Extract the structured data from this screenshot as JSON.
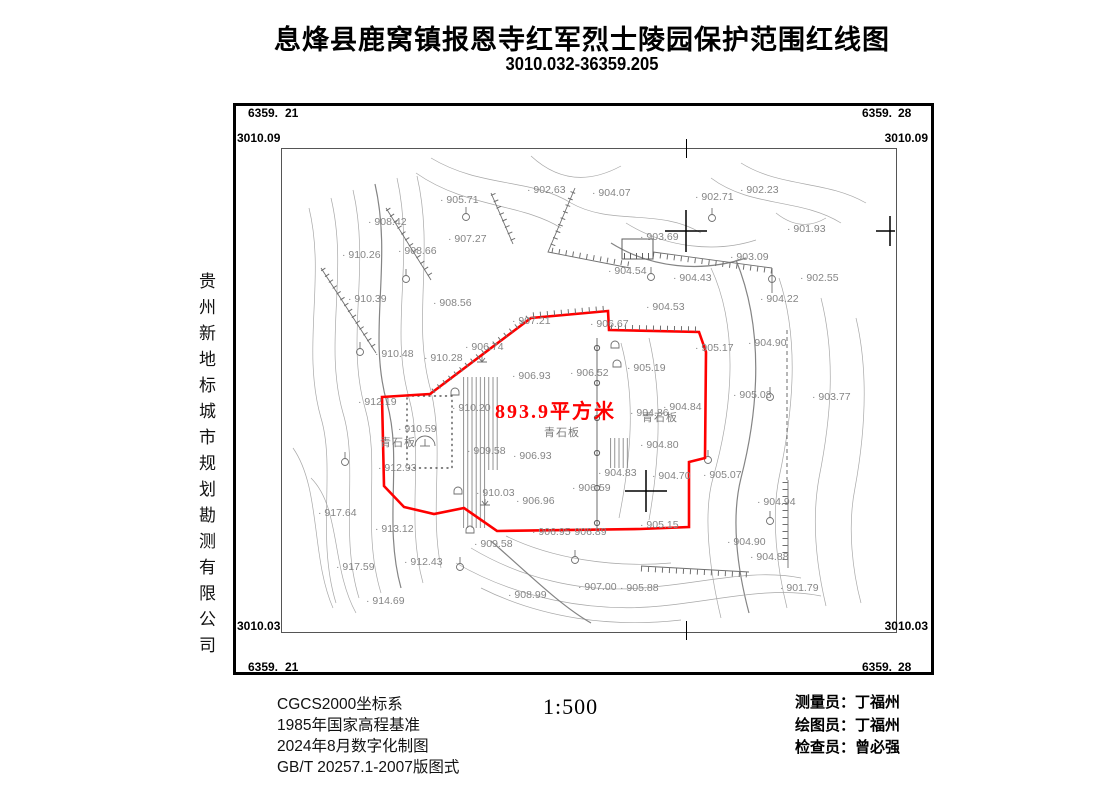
{
  "title": "息烽县鹿窝镇报恩寺红军烈士陵园保护范围红线图",
  "subtitle": "3010.032-36359.205",
  "company_vertical": "贵州新地标城市规划勘测有限公司",
  "frame_coords": {
    "top_left": {
      "easting_prefix": "6359.",
      "easting_suffix": "21",
      "northing": "3010.09"
    },
    "top_right": {
      "easting_prefix": "6359.",
      "easting_suffix": "28",
      "northing": "3010.09"
    },
    "bottom_left": {
      "easting_prefix": "6359.",
      "easting_suffix": "21",
      "northing": "3010.03"
    },
    "bottom_right": {
      "easting_prefix": "6359.",
      "easting_suffix": "28",
      "northing": "3010.03"
    }
  },
  "map": {
    "area_label": "893.9平方米",
    "red_line_color": "#fe0000",
    "contour_color": "#a0a0a0",
    "spot_label_color": "#858585",
    "surface_labels": [
      "青石板",
      "青石板",
      "青石板"
    ],
    "spot_elevations": [
      {
        "x": 159,
        "y": 55,
        "v": "905.71"
      },
      {
        "x": 246,
        "y": 45,
        "v": "902.63"
      },
      {
        "x": 311,
        "y": 48,
        "v": "904.07"
      },
      {
        "x": 414,
        "y": 52,
        "v": "902.71"
      },
      {
        "x": 459,
        "y": 45,
        "v": "902.23"
      },
      {
        "x": 87,
        "y": 77,
        "v": "908.42"
      },
      {
        "x": 506,
        "y": 84,
        "v": "901.93"
      },
      {
        "x": 167,
        "y": 94,
        "v": "907.27"
      },
      {
        "x": 359,
        "y": 92,
        "v": "903.69"
      },
      {
        "x": 61,
        "y": 110,
        "v": "910.26"
      },
      {
        "x": 117,
        "y": 106,
        "v": "908.66"
      },
      {
        "x": 449,
        "y": 112,
        "v": "903.09"
      },
      {
        "x": 327,
        "y": 126,
        "v": "904.54"
      },
      {
        "x": 392,
        "y": 133,
        "v": "904.43"
      },
      {
        "x": 519,
        "y": 133,
        "v": "902.55"
      },
      {
        "x": 67,
        "y": 154,
        "v": "910.39"
      },
      {
        "x": 152,
        "y": 158,
        "v": "908.56"
      },
      {
        "x": 479,
        "y": 154,
        "v": "904.22"
      },
      {
        "x": 365,
        "y": 162,
        "v": "904.53"
      },
      {
        "x": 231,
        "y": 176,
        "v": "907.21"
      },
      {
        "x": 309,
        "y": 179,
        "v": "906.67"
      },
      {
        "x": 414,
        "y": 203,
        "v": "905.17"
      },
      {
        "x": 467,
        "y": 198,
        "v": "904.90"
      },
      {
        "x": 94,
        "y": 209,
        "v": "910.48"
      },
      {
        "x": 143,
        "y": 213,
        "v": "910.28"
      },
      {
        "x": 184,
        "y": 202,
        "v": "906.74"
      },
      {
        "x": 231,
        "y": 231,
        "v": "906.93"
      },
      {
        "x": 289,
        "y": 228,
        "v": "906.52"
      },
      {
        "x": 346,
        "y": 223,
        "v": "905.19"
      },
      {
        "x": 452,
        "y": 250,
        "v": "905.08"
      },
      {
        "x": 531,
        "y": 252,
        "v": "903.77"
      },
      {
        "x": 77,
        "y": 257,
        "v": "912.19"
      },
      {
        "x": 171,
        "y": 263,
        "v": "910.20"
      },
      {
        "x": 382,
        "y": 262,
        "v": "904.84"
      },
      {
        "x": 349,
        "y": 268,
        "v": "904.86"
      },
      {
        "x": 117,
        "y": 284,
        "v": "910.59"
      },
      {
        "x": 359,
        "y": 300,
        "v": "904.80"
      },
      {
        "x": 186,
        "y": 306,
        "v": "909.58"
      },
      {
        "x": 232,
        "y": 311,
        "v": "906.93"
      },
      {
        "x": 97,
        "y": 323,
        "v": "912.93"
      },
      {
        "x": 317,
        "y": 328,
        "v": "904.83"
      },
      {
        "x": 371,
        "y": 331,
        "v": "904.70"
      },
      {
        "x": 422,
        "y": 330,
        "v": "905.07"
      },
      {
        "x": 291,
        "y": 343,
        "v": "906.59"
      },
      {
        "x": 235,
        "y": 356,
        "v": "906.96"
      },
      {
        "x": 195,
        "y": 348,
        "v": "910.03"
      },
      {
        "x": 476,
        "y": 357,
        "v": "904.94"
      },
      {
        "x": 37,
        "y": 368,
        "v": "917.64"
      },
      {
        "x": 94,
        "y": 384,
        "v": "913.12"
      },
      {
        "x": 251,
        "y": 387,
        "v": "906.95"
      },
      {
        "x": 287,
        "y": 387,
        "v": "906.89"
      },
      {
        "x": 359,
        "y": 380,
        "v": "905.15"
      },
      {
        "x": 446,
        "y": 397,
        "v": "904.90"
      },
      {
        "x": 469,
        "y": 412,
        "v": "904.88"
      },
      {
        "x": 55,
        "y": 422,
        "v": "917.59"
      },
      {
        "x": 123,
        "y": 417,
        "v": "912.43"
      },
      {
        "x": 193,
        "y": 399,
        "v": "909.58"
      },
      {
        "x": 227,
        "y": 450,
        "v": "908.99"
      },
      {
        "x": 85,
        "y": 456,
        "v": "914.69"
      },
      {
        "x": 297,
        "y": 442,
        "v": "907.00"
      },
      {
        "x": 339,
        "y": 443,
        "v": "905.88"
      },
      {
        "x": 499,
        "y": 443,
        "v": "901.79"
      }
    ]
  },
  "footer": {
    "lines": [
      "CGCS2000坐标系",
      "1985年国家高程基准",
      "2024年8月数字化制图",
      "GB/T  20257.1-2007版图式"
    ],
    "scale": "1:500"
  },
  "personnel": [
    {
      "label": "测量员：",
      "name": "丁福州"
    },
    {
      "label": "绘图员：",
      "name": "丁福州"
    },
    {
      "label": "检查员：",
      "name": "曾必强"
    }
  ]
}
